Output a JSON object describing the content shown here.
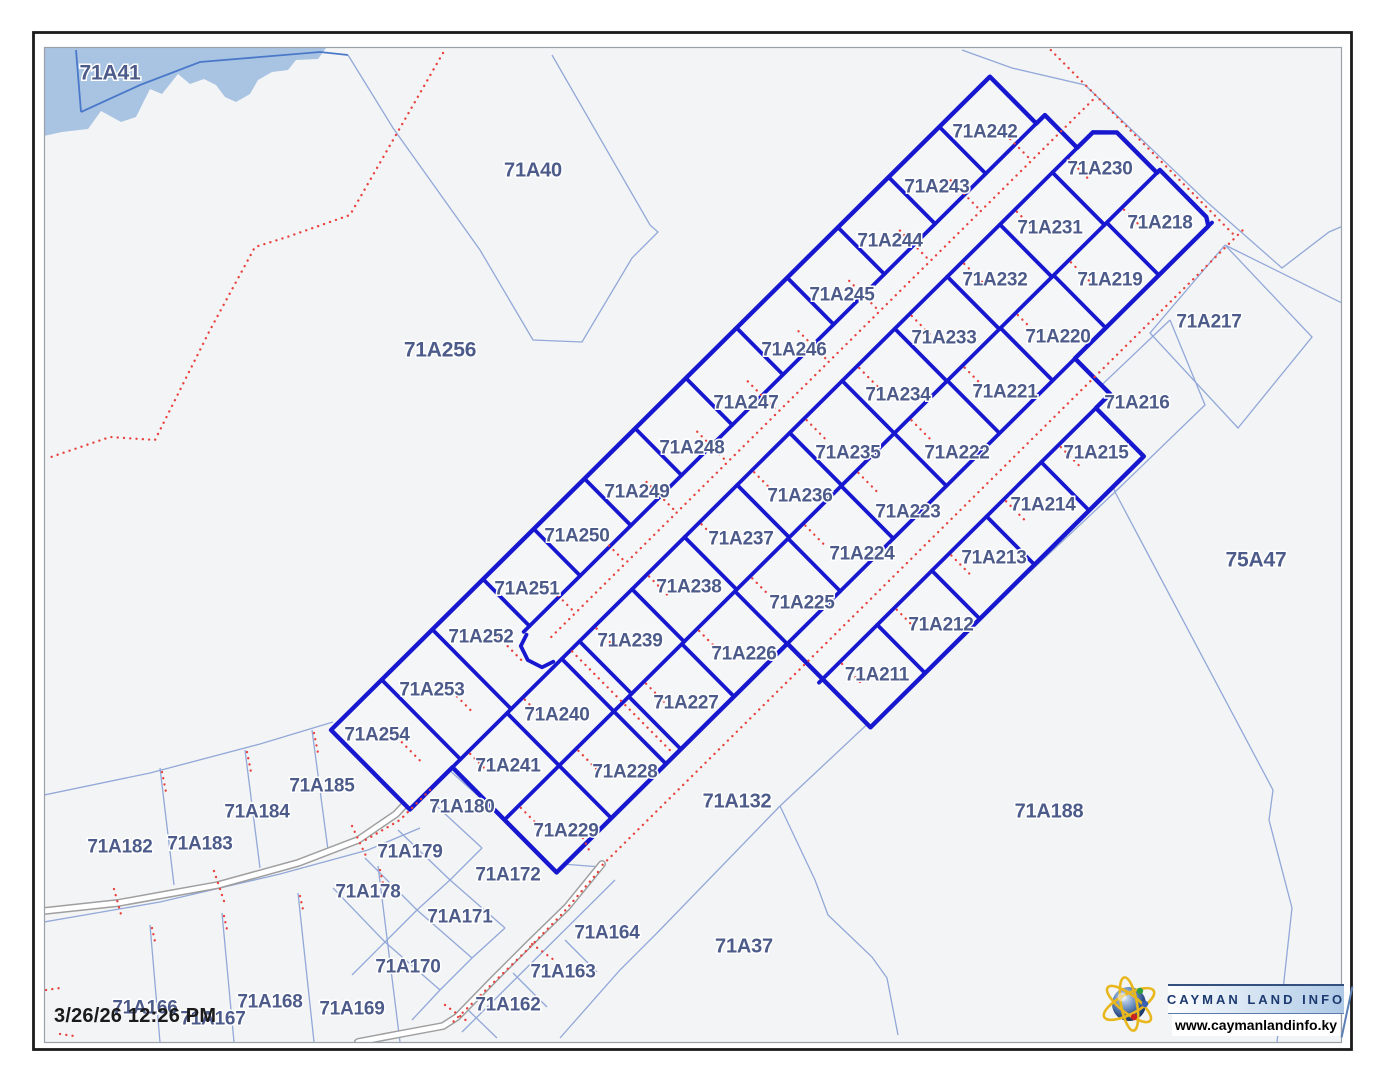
{
  "map": {
    "timestamp": "3/26/26 12:26 PM",
    "logo": {
      "title": "CAYMAN LAND INFO",
      "url": "www.caymanlandinfo.ky",
      "icon": "globe-icon"
    },
    "colors": {
      "map_background": "#f3f4f6",
      "highlight_parcel_line": "#1717cf",
      "background_parcel_line": "#92a8d8",
      "water_fill": "#a9c4e2",
      "water_line": "#4b79c9",
      "survey_dotted_line": "#e8413c",
      "road_casing": "#9f9f9f",
      "road_fill": "#ffffff",
      "parcel_label": "#4d5b8a",
      "frame": "#1c1c1c",
      "logo_navy": "#1c3a70"
    },
    "parcels": {
      "highlighted": [
        {
          "label": "71A242",
          "x": 985,
          "y": 131
        },
        {
          "label": "71A243",
          "x": 937,
          "y": 186
        },
        {
          "label": "71A244",
          "x": 890,
          "y": 240
        },
        {
          "label": "71A245",
          "x": 842,
          "y": 294
        },
        {
          "label": "71A246",
          "x": 794,
          "y": 349
        },
        {
          "label": "71A247",
          "x": 746,
          "y": 402
        },
        {
          "label": "71A248",
          "x": 692,
          "y": 447
        },
        {
          "label": "71A249",
          "x": 637,
          "y": 491
        },
        {
          "label": "71A250",
          "x": 577,
          "y": 535
        },
        {
          "label": "71A251",
          "x": 527,
          "y": 588
        },
        {
          "label": "71A252",
          "x": 481,
          "y": 636
        },
        {
          "label": "71A253",
          "x": 432,
          "y": 689
        },
        {
          "label": "71A254",
          "x": 377,
          "y": 734
        },
        {
          "label": "71A230",
          "x": 1100,
          "y": 168
        },
        {
          "label": "71A231",
          "x": 1050,
          "y": 227
        },
        {
          "label": "71A232",
          "x": 995,
          "y": 279
        },
        {
          "label": "71A233",
          "x": 944,
          "y": 337
        },
        {
          "label": "71A234",
          "x": 898,
          "y": 394
        },
        {
          "label": "71A235",
          "x": 848,
          "y": 452
        },
        {
          "label": "71A236",
          "x": 800,
          "y": 495
        },
        {
          "label": "71A237",
          "x": 741,
          "y": 538
        },
        {
          "label": "71A238",
          "x": 689,
          "y": 586
        },
        {
          "label": "71A239",
          "x": 630,
          "y": 640
        },
        {
          "label": "71A240",
          "x": 557,
          "y": 714
        },
        {
          "label": "71A241",
          "x": 508,
          "y": 765
        },
        {
          "label": "71A218",
          "x": 1160,
          "y": 222
        },
        {
          "label": "71A219",
          "x": 1110,
          "y": 279
        },
        {
          "label": "71A220",
          "x": 1058,
          "y": 336
        },
        {
          "label": "71A221",
          "x": 1005,
          "y": 391
        },
        {
          "label": "71A222",
          "x": 957,
          "y": 452
        },
        {
          "label": "71A223",
          "x": 908,
          "y": 511
        },
        {
          "label": "71A224",
          "x": 862,
          "y": 553
        },
        {
          "label": "71A225",
          "x": 802,
          "y": 602
        },
        {
          "label": "71A226",
          "x": 744,
          "y": 653
        },
        {
          "label": "71A227",
          "x": 686,
          "y": 702
        },
        {
          "label": "71A228",
          "x": 625,
          "y": 771
        },
        {
          "label": "71A229",
          "x": 566,
          "y": 830
        },
        {
          "label": "71A215",
          "x": 1096,
          "y": 452
        },
        {
          "label": "71A214",
          "x": 1043,
          "y": 504
        },
        {
          "label": "71A213",
          "x": 994,
          "y": 557
        },
        {
          "label": "71A212",
          "x": 941,
          "y": 624
        },
        {
          "label": "71A211",
          "x": 877,
          "y": 674
        }
      ],
      "background": [
        {
          "label": "71A41",
          "x": 110,
          "y": 73,
          "s": 21
        },
        {
          "label": "71A40",
          "x": 533,
          "y": 170,
          "s": 20
        },
        {
          "label": "71A256",
          "x": 440,
          "y": 350,
          "s": 21
        },
        {
          "label": "71A217",
          "x": 1209,
          "y": 321
        },
        {
          "label": "71A216",
          "x": 1137,
          "y": 402
        },
        {
          "label": "75A47",
          "x": 1256,
          "y": 560,
          "s": 21
        },
        {
          "label": "71A132",
          "x": 737,
          "y": 801,
          "s": 20
        },
        {
          "label": "71A188",
          "x": 1049,
          "y": 811,
          "s": 20
        },
        {
          "label": "71A37",
          "x": 744,
          "y": 946,
          "s": 20
        },
        {
          "label": "71A185",
          "x": 322,
          "y": 785
        },
        {
          "label": "71A184",
          "x": 257,
          "y": 811
        },
        {
          "label": "71A183",
          "x": 200,
          "y": 843
        },
        {
          "label": "71A182",
          "x": 120,
          "y": 846
        },
        {
          "label": "71A180",
          "x": 462,
          "y": 806
        },
        {
          "label": "71A179",
          "x": 410,
          "y": 851
        },
        {
          "label": "71A178",
          "x": 368,
          "y": 891
        },
        {
          "label": "71A172",
          "x": 508,
          "y": 874
        },
        {
          "label": "71A171",
          "x": 460,
          "y": 916
        },
        {
          "label": "71A170",
          "x": 408,
          "y": 966
        },
        {
          "label": "71A164",
          "x": 607,
          "y": 932
        },
        {
          "label": "71A163",
          "x": 563,
          "y": 971
        },
        {
          "label": "71A162",
          "x": 508,
          "y": 1004
        },
        {
          "label": "71A166",
          "x": 145,
          "y": 1007
        },
        {
          "label": "71A167",
          "x": 213,
          "y": 1018
        },
        {
          "label": "71A168",
          "x": 270,
          "y": 1001
        },
        {
          "label": "71A169",
          "x": 352,
          "y": 1008
        }
      ]
    }
  }
}
